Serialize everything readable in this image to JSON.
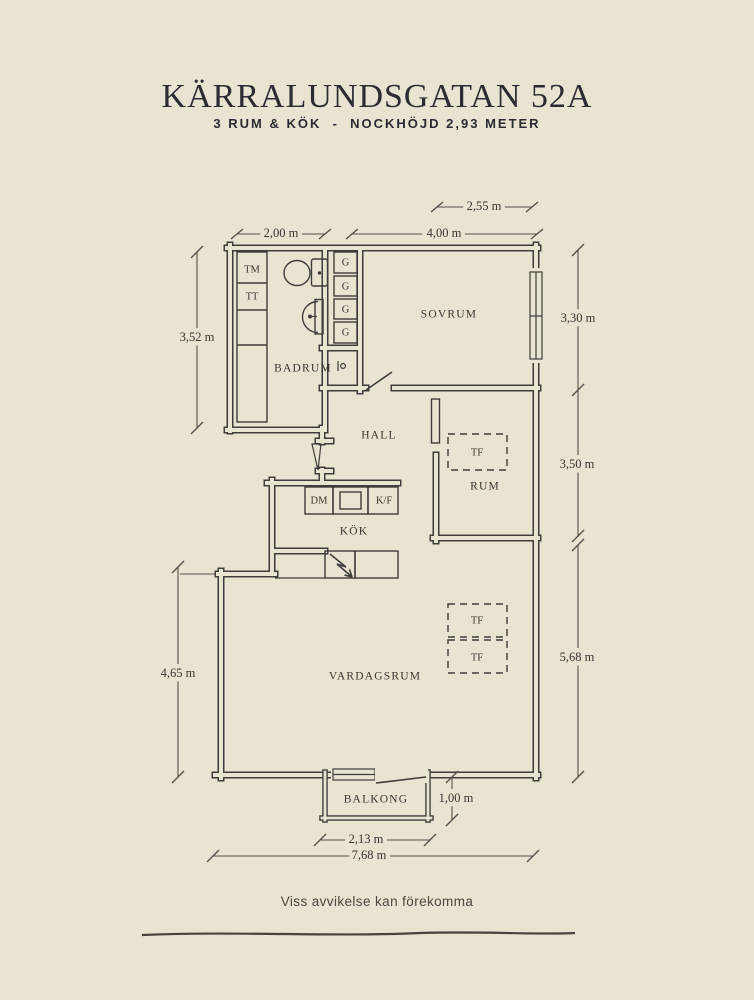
{
  "header": {
    "title": "KÄRRALUNDSGATAN 52A",
    "subtitle": "3 RUM & KÖK  -  NOCKHÖJD 2,93 METER"
  },
  "rooms": {
    "sovrum": {
      "label": "SOVRUM"
    },
    "badrum": {
      "label": "BADRUM"
    },
    "hall": {
      "label": "HALL"
    },
    "kok": {
      "label": "KÖK"
    },
    "rum": {
      "label": "RUM"
    },
    "vardagsrum": {
      "label": "VARDAGSRUM"
    },
    "balkong": {
      "label": "BALKONG"
    }
  },
  "fixtures": {
    "tm": "TM",
    "tt": "TT",
    "g": "G",
    "dm": "DM",
    "kf": "K/F",
    "tf": "TF"
  },
  "dimensions": {
    "d_255": "2,55 m",
    "d_200": "2,00 m",
    "d_400": "4,00 m",
    "d_352": "3,52 m",
    "d_330": "3,30 m",
    "d_350": "3,50 m",
    "d_568": "5,68 m",
    "d_465": "4,65 m",
    "d_100": "1,00 m",
    "d_213": "2,13 m",
    "d_768": "7,68 m"
  },
  "footer": {
    "disclaimer": "Viss avvikelse kan förekomma"
  },
  "colors": {
    "background": "#e9e3d2",
    "wall_line": "#3f3d39",
    "dimension_line": "#55504a",
    "text": "#38352f",
    "title_text": "#2c2b31"
  }
}
